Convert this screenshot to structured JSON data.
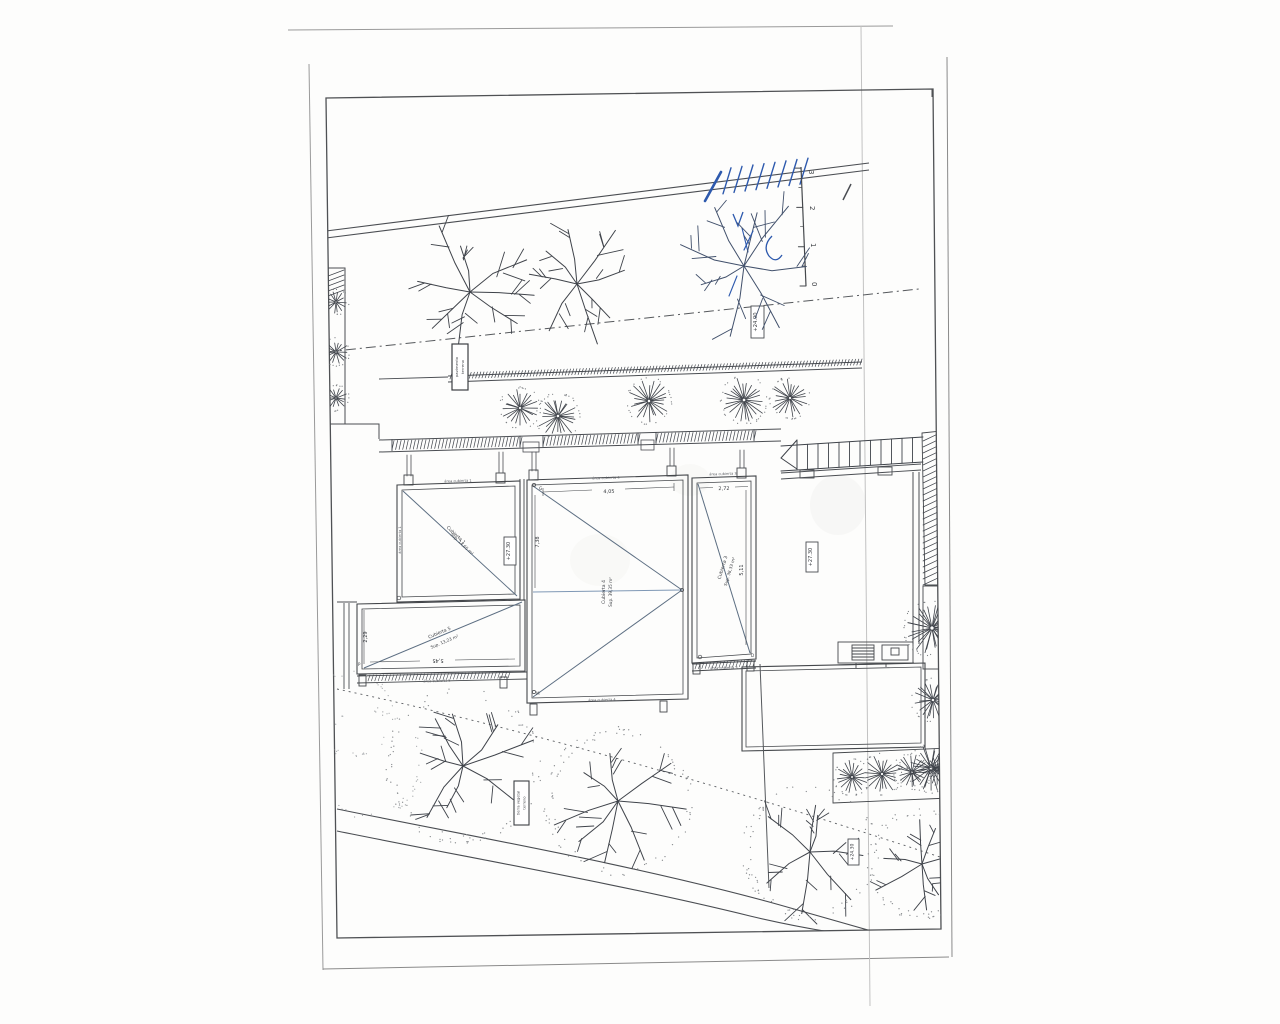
{
  "sheet": {
    "roofs": {
      "c1": {
        "name": "Cubierta 1",
        "area": "Sup. 14,65 m²",
        "edge_label": "área cubierta 1"
      },
      "c3": {
        "name": "Cubierta 3",
        "area": "Sup. 38,33 m²",
        "edge_label": "área cubierta 3"
      },
      "c4": {
        "name": "Cubierta 4",
        "area": "Sup. 39,35 m²",
        "edge_label": "área cubierta 4"
      },
      "c5": {
        "name": "Cubierta 5",
        "area": "Sup. 13,23 m²",
        "edge_label": "área cubierta 5"
      }
    },
    "dimensions": {
      "c5_width": "5,45",
      "c5_depth": "2,29",
      "c4_width": "4,05",
      "c4_depth": "7,38",
      "c3_width": "2,72",
      "c3_depth": "5,11"
    },
    "elevations": {
      "roof_gap": "+27.30",
      "terrace": "+27.30",
      "upper_garden": "+24.90",
      "lower_garden": "+24.30"
    },
    "scale_bar": {
      "ticks": [
        "0",
        "1",
        "2",
        "3"
      ]
    },
    "surface_labels": {
      "upper": {
        "line1": "pavimento",
        "line2": "terreno"
      },
      "lower": {
        "line1": "tierra vegetal",
        "line2": "terreno"
      }
    },
    "corner_marks": {
      "g": "G",
      "m": "M",
      "p": "P",
      "d": "D"
    }
  }
}
